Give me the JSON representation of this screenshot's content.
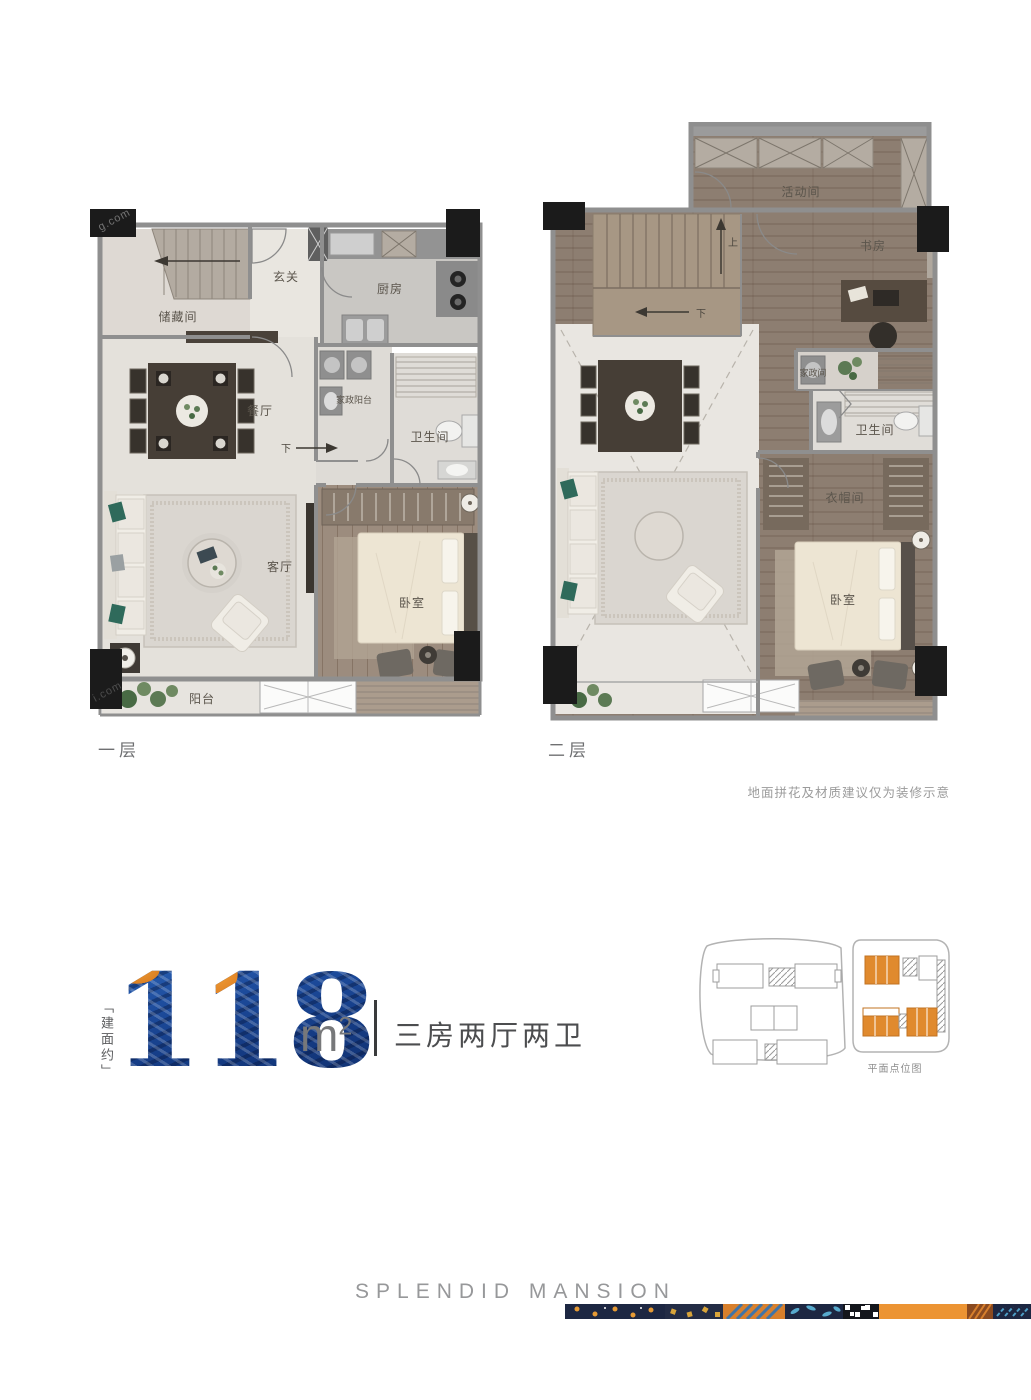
{
  "floor1": {
    "label": "一层",
    "rooms": {
      "storage": "储藏间",
      "entry": "玄关",
      "kitchen": "厨房",
      "dining": "餐厅",
      "laundry": "家政阳台",
      "bath": "卫生间",
      "living": "客厅",
      "bedroom": "卧室",
      "balcony": "阳台"
    },
    "nav": {
      "down": "下"
    }
  },
  "floor2": {
    "label": "二层",
    "rooms": {
      "activity": "活动间",
      "study": "书房",
      "laundry": "家政间",
      "bath": "卫生间",
      "cloak": "衣帽间",
      "bedroom": "卧室"
    },
    "nav": {
      "down": "下",
      "up": "上"
    }
  },
  "disclaimer": "地面拼花及材质建议仅为装修示意",
  "area": {
    "prefix": "「建面约」",
    "value": "118",
    "unit": "m",
    "exponent": "2",
    "layout": "三房两厅两卫"
  },
  "site_map": {
    "caption": "平面点位图"
  },
  "brand": "SPLENDID MANSION",
  "watermark": {
    "top": "g.com",
    "bottom": "i.com"
  },
  "colors": {
    "digits_blue": "#1c4a97",
    "digits_orange": "#e8872b",
    "highlight_orange": "#e08a2e",
    "wall_gray": "#8f8f8f",
    "wood": "#8d7e71",
    "marble": "#e6e3dd",
    "navy": "#1d2742"
  }
}
